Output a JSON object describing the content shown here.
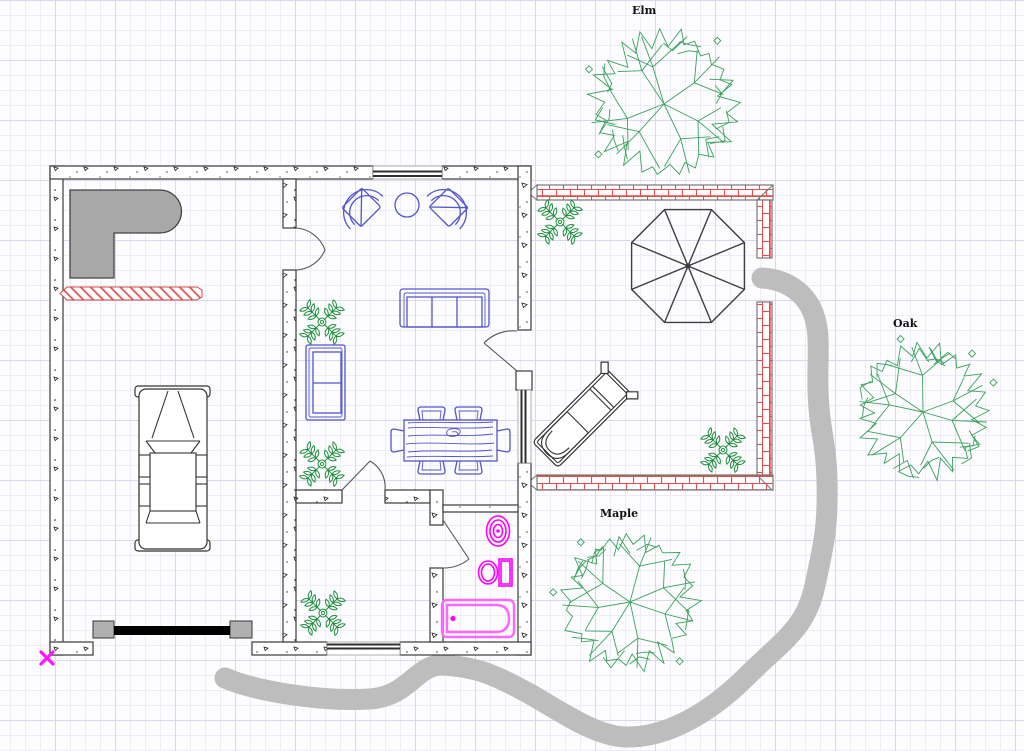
{
  "colors": {
    "grid_minor": "#ededf8",
    "grid_major": "#d8d8ef",
    "wall": "#3a3a3a",
    "wall_speck": "#222222",
    "brick": "#e34d4d",
    "brick_border": "#777777",
    "furniture": "#5454cd",
    "fixture": "#ff00ff",
    "bathtub": "#ff66ff",
    "plant": "#1f8f3c",
    "tree": "#3aa05c",
    "path": "#bdbdbd",
    "counter": "#a8a8a8",
    "door_post": "#b0b0b0",
    "garage_door": "#000000",
    "marker": "#ff14ff",
    "label": "#111111",
    "outline": "#333333"
  },
  "trees": [
    {
      "name": "elm",
      "label": "Elm",
      "cx": 664,
      "cy": 104,
      "r": 78,
      "label_x": 632,
      "label_y": 14,
      "seed": 7
    },
    {
      "name": "oak",
      "label": "Oak",
      "cx": 923,
      "cy": 412,
      "r": 72,
      "label_x": 893,
      "label_y": 327,
      "seed": 13
    },
    {
      "name": "maple",
      "label": "Maple",
      "cx": 630,
      "cy": 602,
      "r": 73,
      "label_x": 600,
      "label_y": 517,
      "seed": 29
    }
  ],
  "plants": [
    {
      "cx": 322,
      "cy": 322
    },
    {
      "cx": 322,
      "cy": 464
    },
    {
      "cx": 323,
      "cy": 613
    },
    {
      "cx": 560,
      "cy": 222
    },
    {
      "cx": 723,
      "cy": 450
    }
  ]
}
